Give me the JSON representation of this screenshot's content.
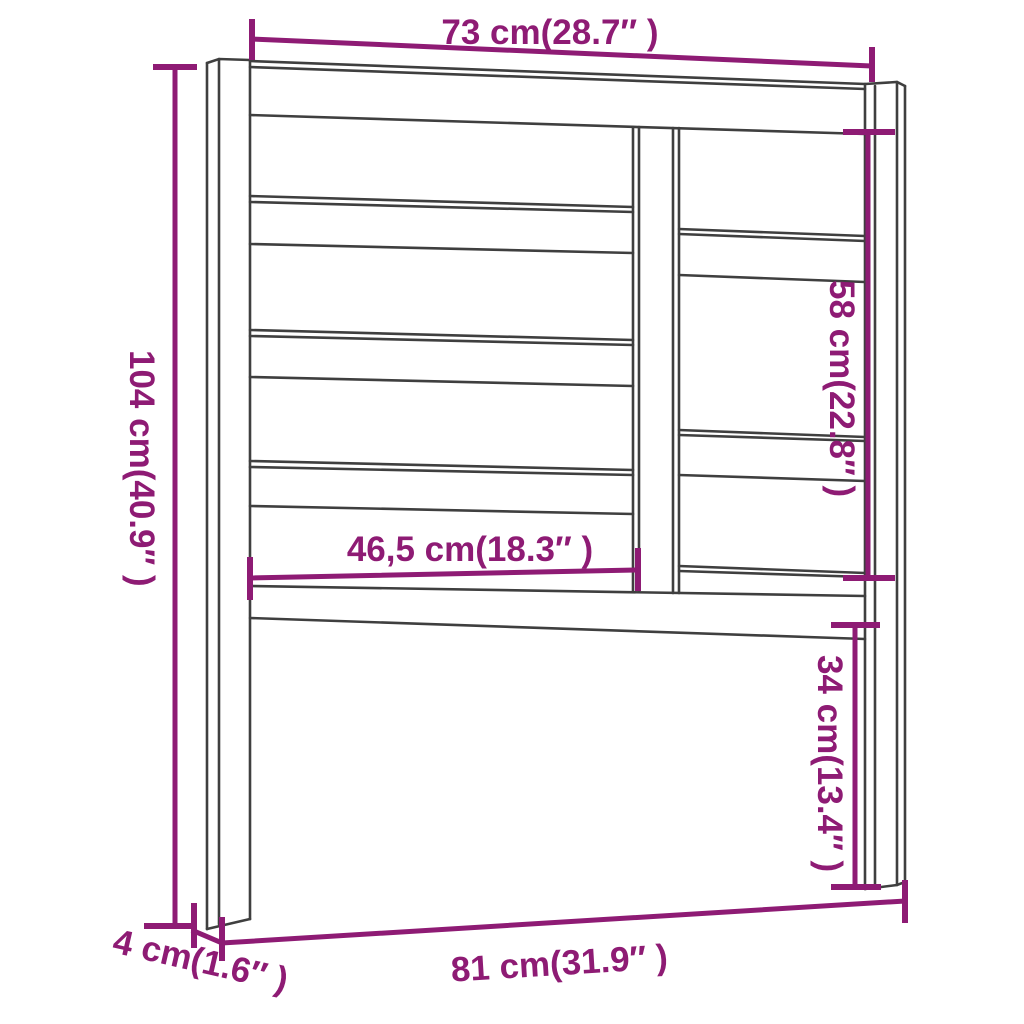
{
  "figure": {
    "type": "furniture-dimension-diagram",
    "subject": "bed headboard with slatted panel and two legs"
  },
  "colors": {
    "background": "#ffffff",
    "outline": "#3f3f3f",
    "dimension_accent": "#8E1B74"
  },
  "dimensions": {
    "top_width": {
      "label": "73 cm(28.7″ )",
      "cm": 73,
      "inches": 28.7
    },
    "overall_height": {
      "label": "104 cm(40.9″ )",
      "cm": 104,
      "inches": 40.9
    },
    "panel_height": {
      "label": "58 cm(22.8″ )",
      "cm": 58,
      "inches": 22.8
    },
    "inner_width": {
      "label": "46,5 cm(18.3″ )",
      "cm": 46.5,
      "inches": 18.3
    },
    "leg_lower_height": {
      "label": "34 cm(13.4″ )",
      "cm": 34,
      "inches": 13.4
    },
    "bottom_width": {
      "label": "81 cm(31.9″ )",
      "cm": 81,
      "inches": 31.9
    },
    "leg_depth": {
      "label": "4 cm(1.6″ )",
      "cm": 4,
      "inches": 1.6
    }
  }
}
